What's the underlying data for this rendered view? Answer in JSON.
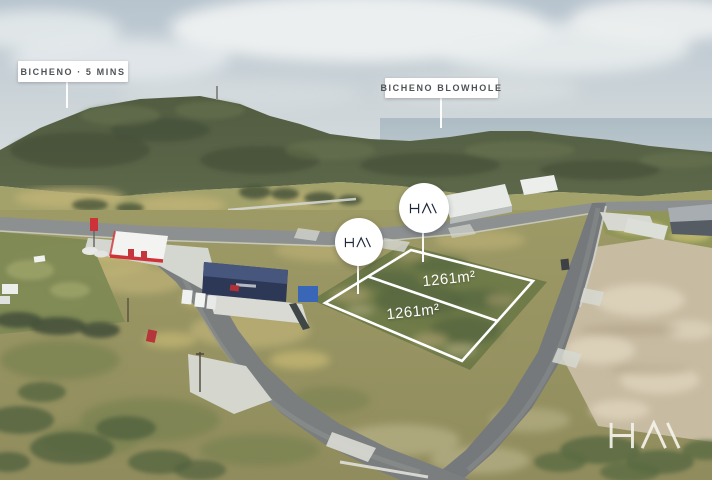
{
  "annotations": {
    "bicheno": {
      "label": "BICHENO · 5 MINS"
    },
    "blowhole": {
      "label": "BICHENO BLOWHOLE"
    }
  },
  "lots": {
    "upper": {
      "area": "1261m²"
    },
    "lower": {
      "area": "1261m²"
    }
  },
  "branding": {
    "logo_glyph": "HΛ\\",
    "logo_alt": "HΛ\\ agency logo"
  },
  "colors": {
    "overlay_white": "#ffffff",
    "logo_navy": "#20263e",
    "label_text": "#4f5356",
    "watermark_cream": "#f5f3ea",
    "canopy_red": "#cf3339"
  }
}
